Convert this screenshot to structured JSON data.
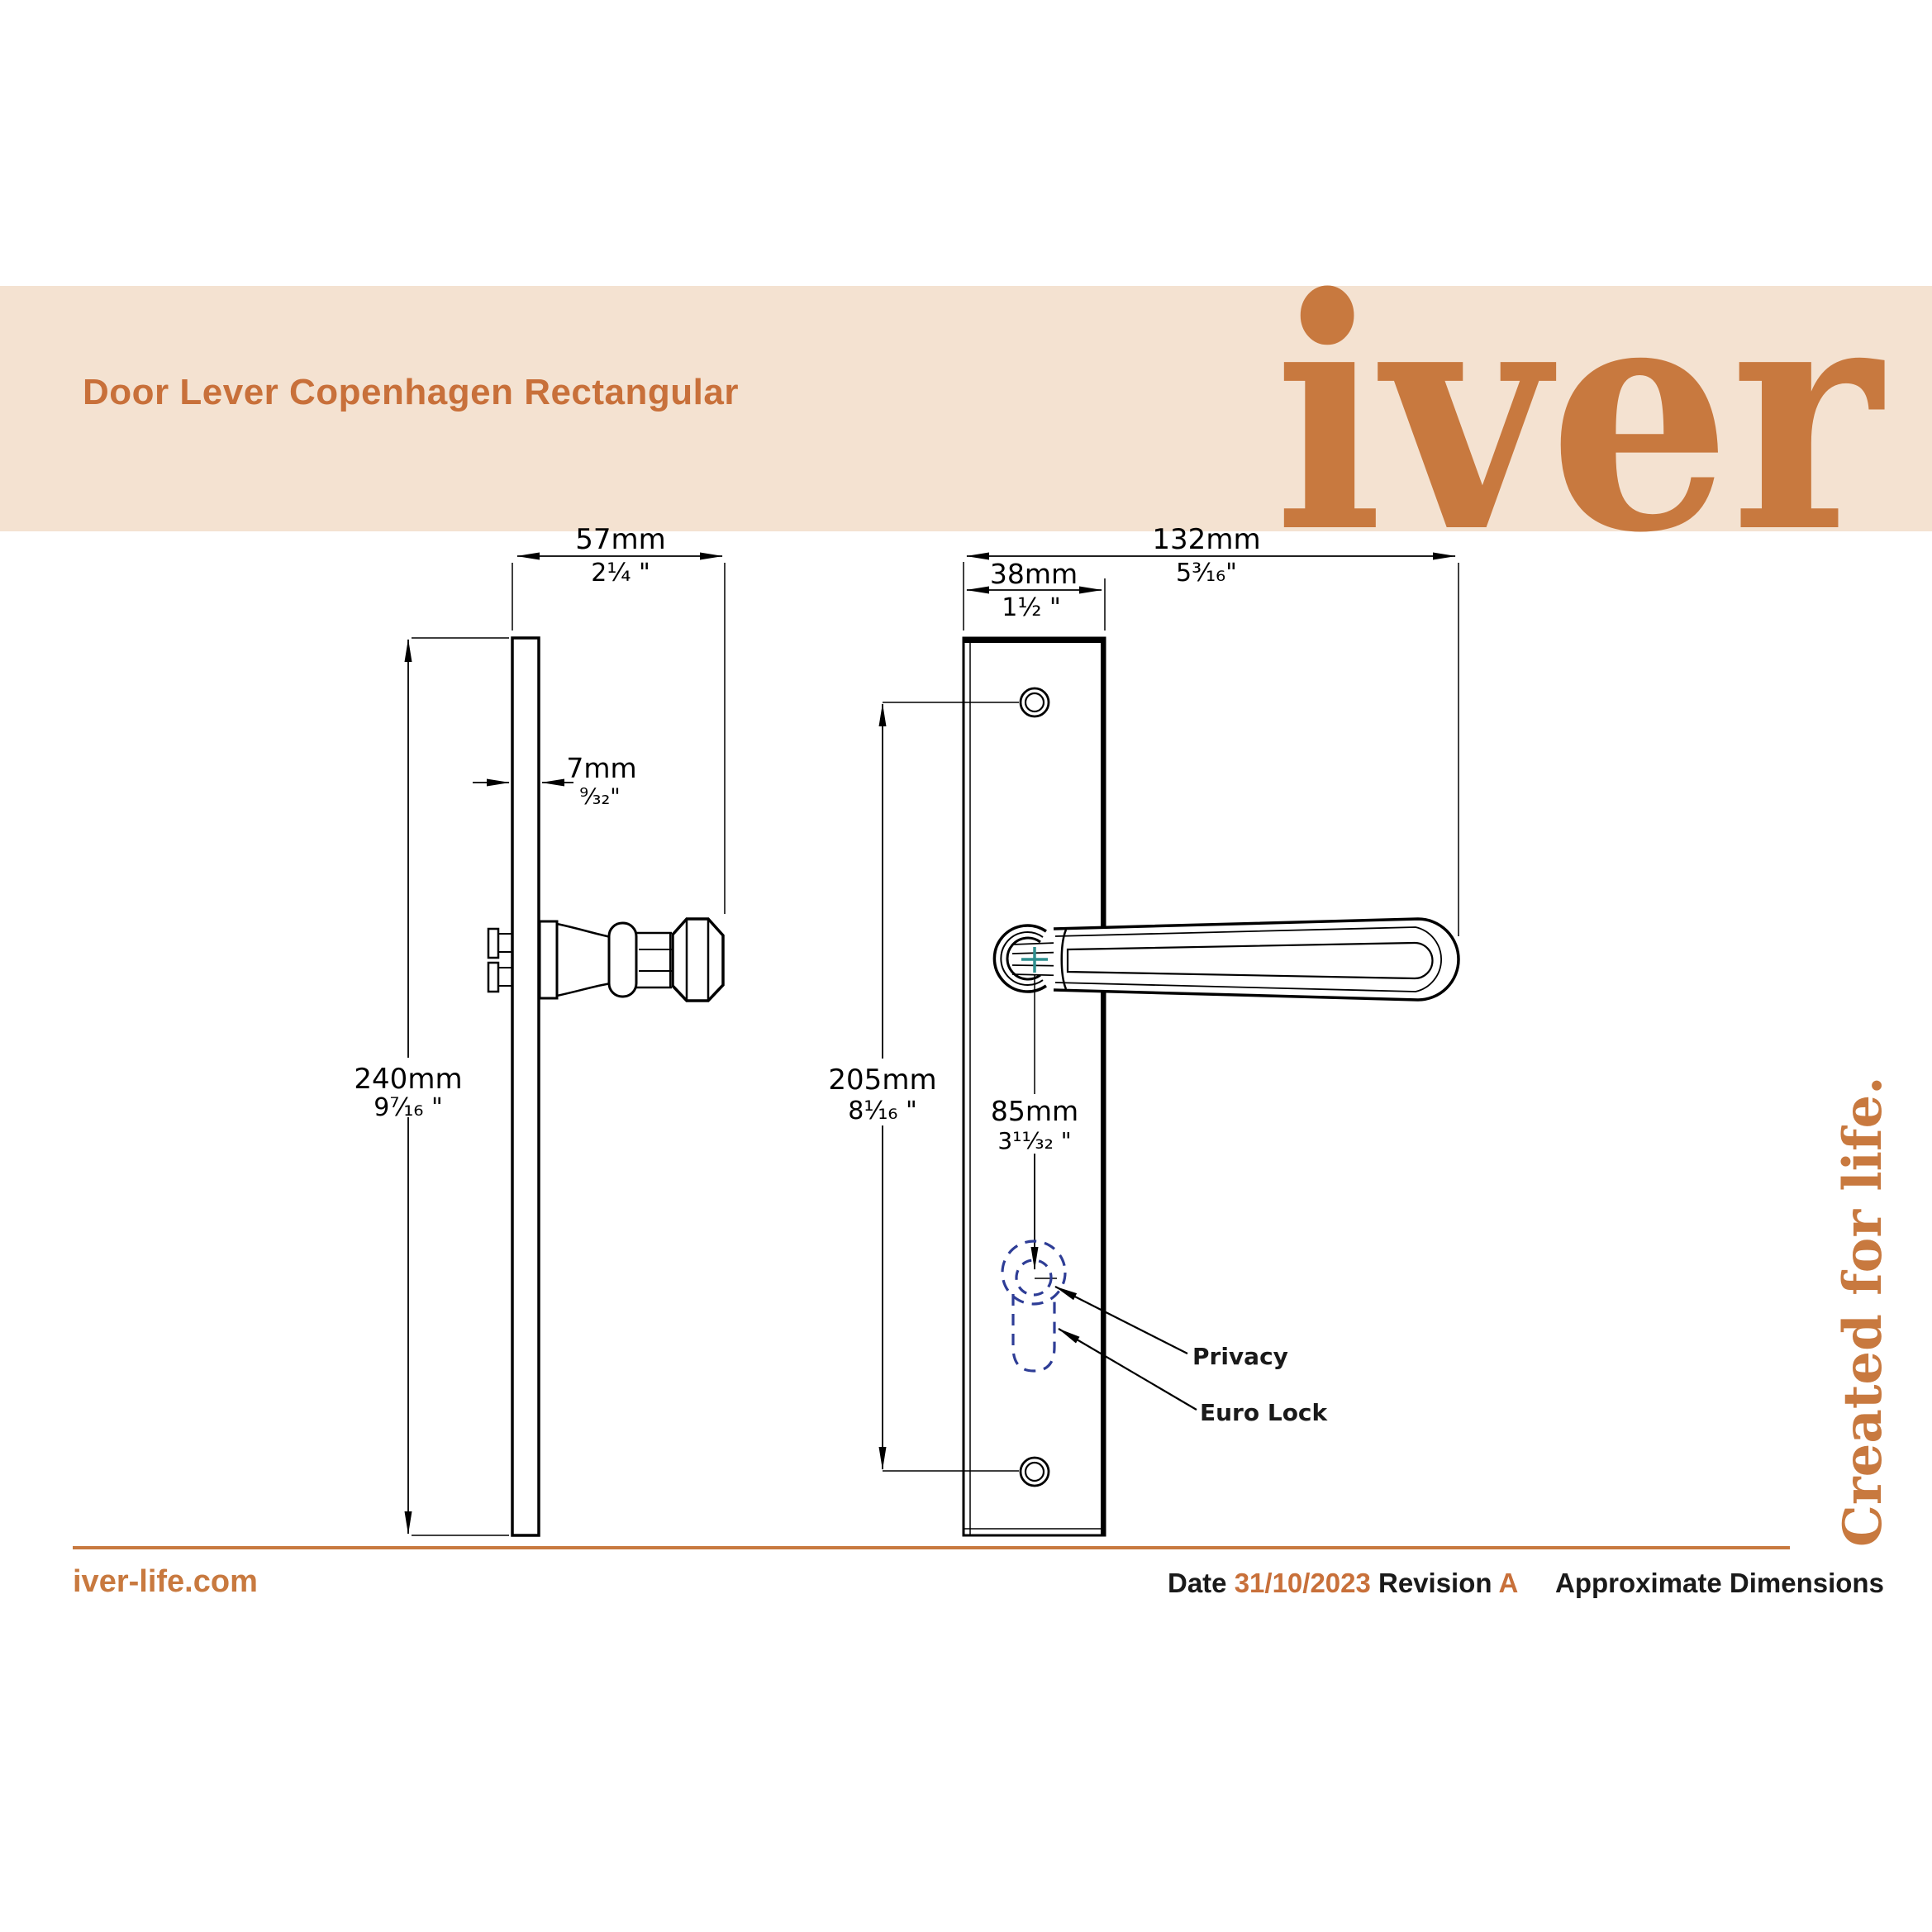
{
  "colors": {
    "accent_orange": "#C8793F",
    "title_orange": "#C8703A",
    "banner_background": "#F4E2D1",
    "lock_dashed_navy": "#2E3D96",
    "spindle_cross_teal": "#2F8F8F",
    "ink": "#1A1A1A"
  },
  "banner": {
    "title": "Door Lever Copenhagen Rectangular",
    "logo_text": "iver"
  },
  "tagline": "Created for life.",
  "drawing": {
    "side_view": {
      "projection_width": {
        "mm": "57mm",
        "in": "2¼ \""
      },
      "plate_thickness": {
        "mm": "7mm",
        "in": "⁹⁄₃₂\""
      },
      "plate_height": {
        "mm": "240mm",
        "in": "9⁷⁄₁₆ \""
      }
    },
    "front_view": {
      "overall_width": {
        "mm": "132mm",
        "in": "5³⁄₁₆\""
      },
      "plate_width": {
        "mm": "38mm",
        "in": "1½ \""
      },
      "fixing_centres": {
        "mm": "205mm",
        "in": "8¹⁄₁₆ \""
      },
      "lock_centre": {
        "mm": "85mm",
        "in": "3¹¹⁄₃₂ \""
      },
      "labels": {
        "privacy": "Privacy",
        "euro_lock": "Euro Lock"
      }
    }
  },
  "footer": {
    "website": "iver-life.com",
    "date_label": "Date",
    "date_value": "31/10/2023",
    "revision_label": "Revision",
    "revision_value": "A",
    "note": "Approximate Dimensions"
  }
}
